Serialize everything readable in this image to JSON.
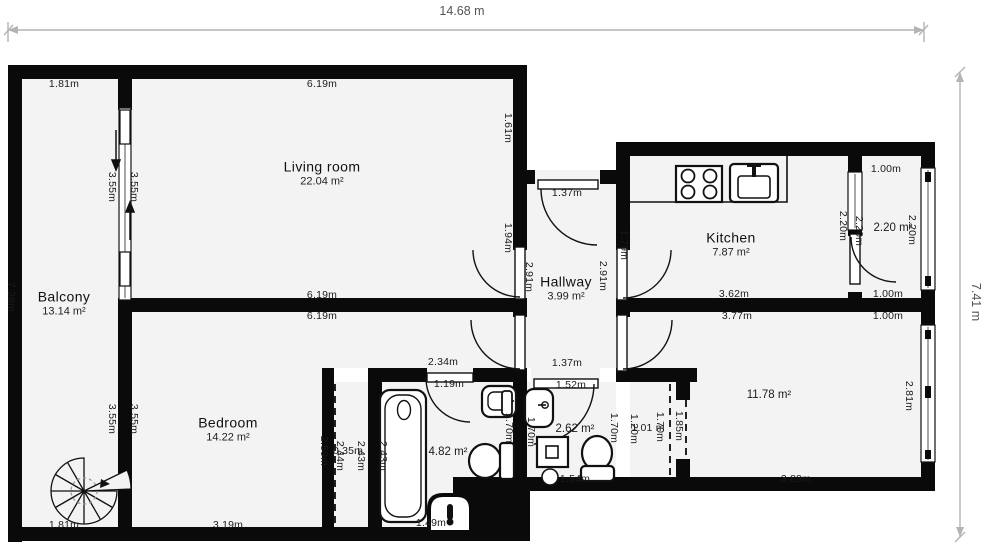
{
  "dimensions": {
    "top": "14.68 m",
    "right": "7.41 m"
  },
  "colors": {
    "wall": "#0a0a0a",
    "floor": "#f3f3f3",
    "dim_line": "#b4b4b4",
    "text": "#1b1b1b"
  },
  "rooms": {
    "balcony": {
      "name": "Balcony",
      "area": "13.14 m²"
    },
    "living": {
      "name": "Living room",
      "area": "22.04 m²"
    },
    "hallway": {
      "name": "Hallway",
      "area": "3.99 m²"
    },
    "kitchen": {
      "name": "Kitchen",
      "area": "7.87 m²"
    },
    "bedroom": {
      "name": "Bedroom",
      "area": "14.22 m²"
    },
    "small_room": {
      "area": "2.20 m²"
    },
    "bathroom": {
      "area": "4.82 m²"
    },
    "wc": {
      "area": "2.62 m²"
    },
    "big_room": {
      "area": "11.78 m²"
    }
  },
  "icons": [
    "spiral-stairs-icon",
    "stove-icon",
    "sink-icon",
    "bathtub-icon",
    "toilet-icon",
    "washing-machine-icon",
    "radiator-icon",
    "door-swing-arc",
    "sliding-door-arrows",
    "window-glyph"
  ],
  "dim_labels": [
    {
      "text": "1.81m",
      "x": 64,
      "y": 84,
      "rot": 0
    },
    {
      "text": "6.19m",
      "x": 322,
      "y": 84,
      "rot": 0
    },
    {
      "text": "1.61m",
      "x": 508,
      "y": 128,
      "rot": 90
    },
    {
      "text": "3.55m",
      "x": 112,
      "y": 187,
      "rot": 90
    },
    {
      "text": "3.55m",
      "x": 134,
      "y": 187,
      "rot": 90
    },
    {
      "text": "7.26m",
      "x": 11,
      "y": 297,
      "rot": 90
    },
    {
      "text": "1.94m",
      "x": 508,
      "y": 238,
      "rot": 90
    },
    {
      "text": "1.37m",
      "x": 567,
      "y": 193,
      "rot": 0
    },
    {
      "text": "1.79m",
      "x": 624,
      "y": 245,
      "rot": 90
    },
    {
      "text": "2.91m",
      "x": 529,
      "y": 277,
      "rot": 90
    },
    {
      "text": "2.91m",
      "x": 603,
      "y": 276,
      "rot": 90
    },
    {
      "text": "1.00m",
      "x": 886,
      "y": 169,
      "rot": 0
    },
    {
      "text": "2.20m",
      "x": 843,
      "y": 226,
      "rot": 90
    },
    {
      "text": "2.20m",
      "x": 859,
      "y": 231,
      "rot": 90
    },
    {
      "text": "2.20m",
      "x": 912,
      "y": 230,
      "rot": 90
    },
    {
      "text": "3.62m",
      "x": 734,
      "y": 294,
      "rot": 0
    },
    {
      "text": "1.00m",
      "x": 888,
      "y": 294,
      "rot": 0
    },
    {
      "text": "6.19m",
      "x": 322,
      "y": 295,
      "rot": 0
    },
    {
      "text": "6.19m",
      "x": 322,
      "y": 316,
      "rot": 0
    },
    {
      "text": "3.77m",
      "x": 737,
      "y": 316,
      "rot": 0
    },
    {
      "text": "1.00m",
      "x": 888,
      "y": 316,
      "rot": 0
    },
    {
      "text": "1.37m",
      "x": 567,
      "y": 363,
      "rot": 0
    },
    {
      "text": "2.34m",
      "x": 443,
      "y": 362,
      "rot": 0
    },
    {
      "text": "1.19m",
      "x": 449,
      "y": 384,
      "rot": 0
    },
    {
      "text": "1.52m",
      "x": 571,
      "y": 385,
      "rot": 0
    },
    {
      "text": "3.55m",
      "x": 112,
      "y": 419,
      "rot": 90
    },
    {
      "text": "3.55m",
      "x": 134,
      "y": 419,
      "rot": 90
    },
    {
      "text": "2.59m",
      "x": 324,
      "y": 451,
      "rot": 90
    },
    {
      "text": "2.44m",
      "x": 340,
      "y": 456,
      "rot": 90
    },
    {
      "text": "0.35m",
      "x": 348,
      "y": 451,
      "rot": 0
    },
    {
      "text": "2.43m",
      "x": 361,
      "y": 456,
      "rot": 90
    },
    {
      "text": "2.43m",
      "x": 383,
      "y": 456,
      "rot": 90
    },
    {
      "text": "1.70m",
      "x": 509,
      "y": 428,
      "rot": 90
    },
    {
      "text": "1.70m",
      "x": 531,
      "y": 432,
      "rot": 90
    },
    {
      "text": "1.70m",
      "x": 614,
      "y": 428,
      "rot": 90
    },
    {
      "text": "1.20m",
      "x": 634,
      "y": 429,
      "rot": 90
    },
    {
      "text": "1.01 m",
      "x": 648,
      "y": 428,
      "rot": 0
    },
    {
      "text": "1.70m",
      "x": 660,
      "y": 427,
      "rot": 90
    },
    {
      "text": "1.85m",
      "x": 679,
      "y": 426,
      "rot": 90
    },
    {
      "text": "2.81m",
      "x": 909,
      "y": 396,
      "rot": 90
    },
    {
      "text": "3.89m",
      "x": 796,
      "y": 479,
      "rot": 0
    },
    {
      "text": "1.54m",
      "x": 575,
      "y": 479,
      "rot": 0
    },
    {
      "text": "1.49m",
      "x": 431,
      "y": 523,
      "rot": 0
    },
    {
      "text": "3.19m",
      "x": 228,
      "y": 525,
      "rot": 0
    },
    {
      "text": "1.81m",
      "x": 64,
      "y": 525,
      "rot": 0
    }
  ]
}
